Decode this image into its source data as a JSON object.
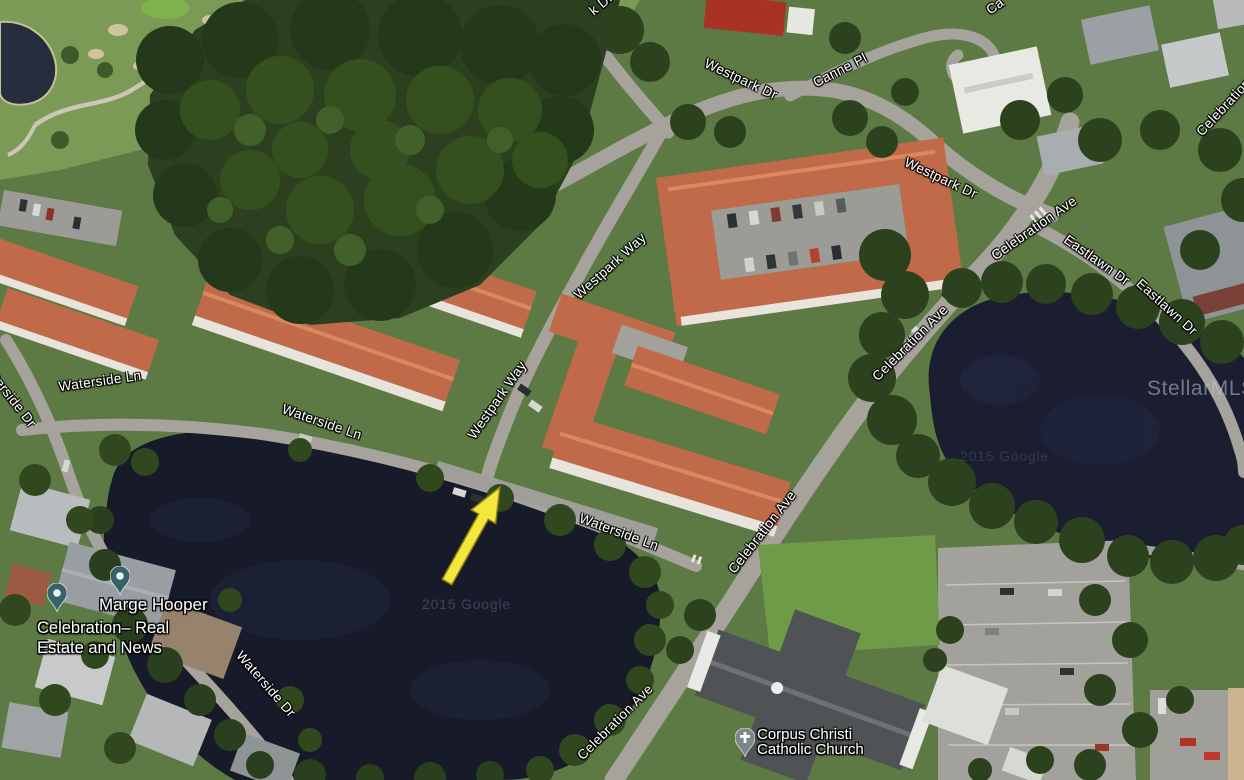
{
  "road_labels": [
    {
      "text": "k Dr"
    },
    {
      "text": "Westpark Dr"
    },
    {
      "text": "Canne Pl"
    },
    {
      "text": "Westpark Dr"
    },
    {
      "text": "Celebration Ave"
    },
    {
      "text": "Celebration Ave"
    },
    {
      "text": "Eastlawn Dr"
    },
    {
      "text": "Eastlawn Dr"
    },
    {
      "text": "Westpark Way"
    },
    {
      "text": "Westpark Way"
    },
    {
      "text": "Waterside Dr"
    },
    {
      "text": "Waterside Ln"
    },
    {
      "text": "Waterside Ln"
    },
    {
      "text": "Waterside Ln"
    },
    {
      "text": "Celebration Ave"
    },
    {
      "text": "Celebration Ave"
    },
    {
      "text": "Celebration Ave"
    },
    {
      "text": "Waterside Dr"
    },
    {
      "text": "Ca"
    }
  ],
  "markers": {
    "business": {
      "name": "Marge Hooper",
      "desc_line1": "Celebration– Real",
      "desc_line2": "Estate and News"
    },
    "church": {
      "line1": "Corpus Christi",
      "line2": "Catholic Church"
    }
  },
  "watermarks": {
    "mls": "StellarMLS",
    "imagery": "2015 Google"
  },
  "annotation": {
    "type": "arrow",
    "direction": "up-right"
  },
  "colors": {
    "water": "#171a29",
    "tree": "#2c401f",
    "grass": "#5d7a44",
    "road": "#a5a39c",
    "roof_tile": "#c06a4a",
    "roof_ridge": "#d8895f",
    "building_white": "#e8e4dc",
    "church_roof": "#4f5356",
    "pin_teal": "#38626b",
    "pin_gray": "#7d8689",
    "arrow": "#f5e63b",
    "label": "#ffffff"
  }
}
